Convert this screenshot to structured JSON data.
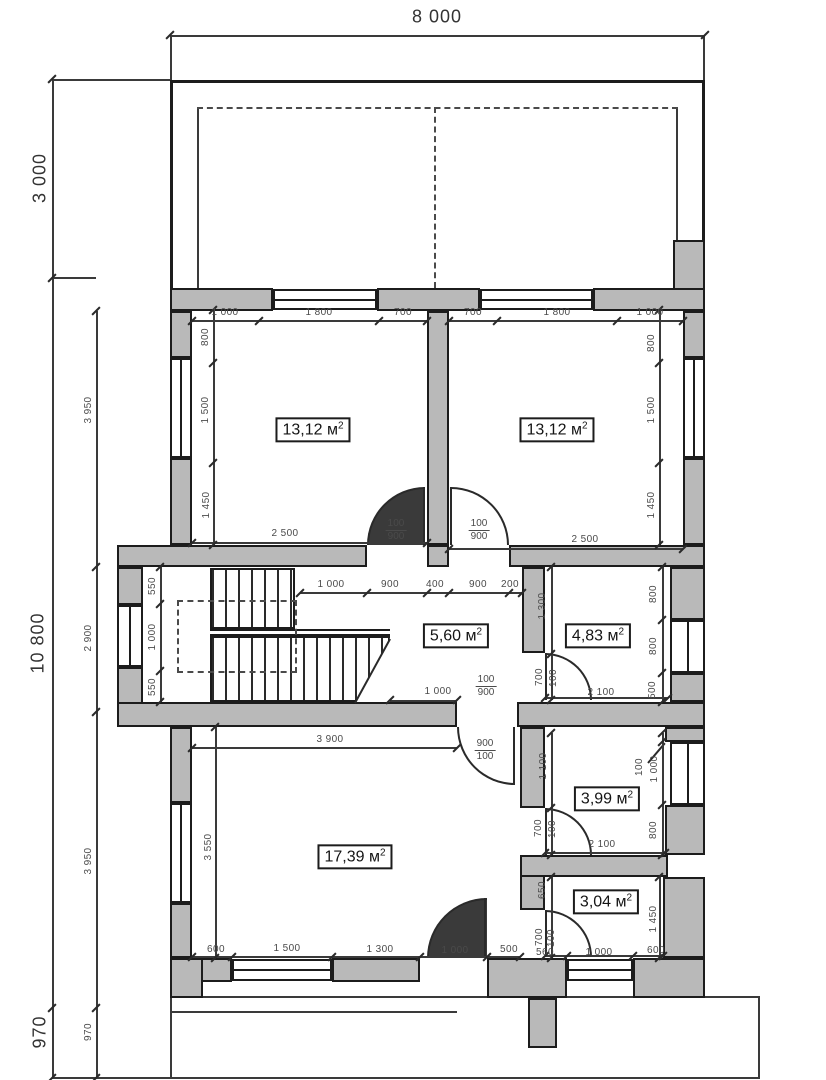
{
  "drawing": {
    "type": "floor-plan",
    "overall_width": "8 000",
    "terrace_depth": "3 000",
    "building_depth": "10 800",
    "porch_depth": "970"
  },
  "area_unit": {
    "base": "м",
    "sup": "2"
  },
  "rooms": [
    {
      "id": "room-1",
      "area": "13,12",
      "x": 313,
      "y": 430
    },
    {
      "id": "room-2",
      "area": "13,12",
      "x": 557,
      "y": 430
    },
    {
      "id": "room-3",
      "area": "5,60",
      "x": 456,
      "y": 636
    },
    {
      "id": "room-4",
      "area": "4,83",
      "x": 598,
      "y": 636
    },
    {
      "id": "room-5",
      "area": "17,39",
      "x": 355,
      "y": 857
    },
    {
      "id": "room-6",
      "area": "3,99",
      "x": 607,
      "y": 799
    },
    {
      "id": "room-7",
      "area": "3,04",
      "x": 606,
      "y": 902
    }
  ],
  "dimensions": {
    "large": [
      [
        "8 000",
        437,
        17,
        0
      ],
      [
        "3 000",
        40,
        178,
        -90
      ],
      [
        "10 800",
        38,
        643,
        -90
      ],
      [
        "970",
        40,
        1032,
        -90
      ]
    ],
    "small": [
      [
        "1 000",
        225,
        313,
        0
      ],
      [
        "1 800",
        319,
        313,
        0
      ],
      [
        "700",
        403,
        313,
        0
      ],
      [
        "700",
        473,
        313,
        0
      ],
      [
        "1 800",
        557,
        313,
        0
      ],
      [
        "1 000",
        650,
        313,
        0
      ],
      [
        "800",
        206,
        337,
        -90
      ],
      [
        "1 500",
        206,
        410,
        -90
      ],
      [
        "1 450",
        207,
        505,
        -90
      ],
      [
        "800",
        652,
        343,
        -90
      ],
      [
        "1 500",
        652,
        410,
        -90
      ],
      [
        "1 450",
        652,
        505,
        -90
      ],
      [
        "2 500",
        285,
        534,
        0
      ],
      [
        "2 500",
        585,
        540,
        0
      ],
      [
        "3 950",
        89,
        410,
        -90
      ],
      [
        "2 900",
        89,
        638,
        -90
      ],
      [
        "3 950",
        89,
        861,
        -90
      ],
      [
        "970",
        89,
        1032,
        -90
      ],
      [
        "550",
        153,
        586,
        -90
      ],
      [
        "1 000",
        153,
        637,
        -90
      ],
      [
        "550",
        153,
        687,
        -90
      ],
      [
        "1 000",
        331,
        585,
        0
      ],
      [
        "900",
        390,
        585,
        0
      ],
      [
        "400",
        435,
        585,
        0
      ],
      [
        "900",
        478,
        585,
        0
      ],
      [
        "200",
        510,
        585,
        0
      ],
      [
        "1 000",
        438,
        692,
        0
      ],
      [
        "1 300",
        543,
        606,
        -90
      ],
      [
        "700",
        540,
        677,
        -90
      ],
      [
        "100",
        554,
        678,
        -90
      ],
      [
        "2 100",
        601,
        693,
        0
      ],
      [
        "800",
        654,
        594,
        -90
      ],
      [
        "800",
        654,
        646,
        -90
      ],
      [
        "500",
        653,
        690,
        -90
      ],
      [
        "3 900",
        330,
        740,
        0
      ],
      [
        "3 550",
        209,
        847,
        -90
      ],
      [
        "600",
        216,
        950,
        0
      ],
      [
        "1 500",
        287,
        949,
        0
      ],
      [
        "1 300",
        380,
        950,
        0
      ],
      [
        "1 000",
        455,
        951,
        0
      ],
      [
        "500",
        509,
        950,
        0
      ],
      [
        "1 100",
        544,
        766,
        -90
      ],
      [
        "700",
        539,
        828,
        -90
      ],
      [
        "100",
        553,
        829,
        -90
      ],
      [
        "2 100",
        602,
        845,
        0
      ],
      [
        "800",
        654,
        830,
        -90
      ],
      [
        "100",
        640,
        767,
        -90
      ],
      [
        "1 000",
        655,
        769,
        -90
      ],
      [
        "650",
        543,
        890,
        -90
      ],
      [
        "700",
        540,
        937,
        -90
      ],
      [
        "100",
        552,
        938,
        -90
      ],
      [
        "560",
        545,
        953,
        0
      ],
      [
        "1 000",
        599,
        953,
        0
      ],
      [
        "600",
        656,
        951,
        0
      ],
      [
        "1 450",
        654,
        919,
        -90
      ]
    ],
    "fractions": [
      {
        "top": "100",
        "bottom": "900",
        "x": 396,
        "y": 530
      },
      {
        "top": "100",
        "bottom": "900",
        "x": 479,
        "y": 530
      },
      {
        "top": "100",
        "bottom": "900",
        "x": 486,
        "y": 686
      },
      {
        "top": "900",
        "bottom": "100",
        "x": 485,
        "y": 750
      }
    ]
  },
  "colors": {
    "wall_fill": "#b9b9b9",
    "outline": "#1c1c1c",
    "dim_text": "#4a4a4a",
    "background": "#ffffff"
  }
}
